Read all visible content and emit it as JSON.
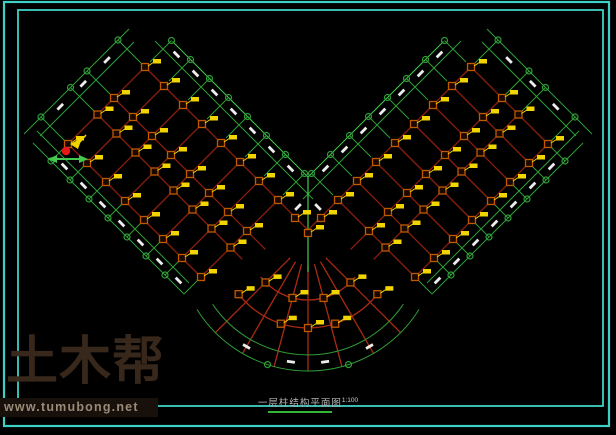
{
  "title_block": {
    "text": "一层柱结构平面图",
    "scale": "1:100"
  },
  "watermark": {
    "brand": "土木帮",
    "url": "www.tumubong.net"
  },
  "colors": {
    "background": "#000000",
    "frame_cyan": "#3fd0c5",
    "axis_green": "#2f9e38",
    "bright_green": "#43c94d",
    "beam_red": "#8b1e0c",
    "fan_red": "#aa2a12",
    "marker_orange": "#c05a00",
    "marker_yellow": "#f2d400",
    "dash_white": "#ededed",
    "symbol_red": "#e81818",
    "title_underline": "#35b535"
  },
  "drawing": {
    "canvas": {
      "w": 616,
      "h": 435
    },
    "mirror_axis": 308,
    "frame": {
      "outer": [
        4,
        2,
        605,
        424
      ],
      "inner": [
        18,
        10,
        585,
        396
      ]
    },
    "wing": {
      "end_s": 158,
      "end_s2": 176,
      "long_axes_c": [
        76,
        17,
        -16,
        -78
      ],
      "short_axes_s": [
        212,
        250,
        288,
        326,
        364,
        402,
        440,
        478
      ],
      "outer_lines_c": [
        94,
        110
      ],
      "inner_lines_c": [
        -114,
        -131
      ],
      "red_end_base": 478,
      "red_end_slope": 0.4,
      "green_long_until_s": 216,
      "outer_green_until_c": 52,
      "inner_green_from_c": -88,
      "dash_end_s": 167,
      "dash_outer_c": 102,
      "dash_inner_c": -122
    },
    "fan": {
      "cx": 308,
      "cy": 240,
      "radial_angles": [
        -45,
        -30,
        -15,
        0,
        15,
        30,
        45
      ],
      "radial_r": [
        25,
        131
      ],
      "red_arc_r": [
        60,
        88
      ],
      "red_arc_span": 52,
      "green_arc_r": [
        115,
        131
      ],
      "green_arc_span": [
        56,
        58
      ],
      "circle_angles": [
        -18,
        18
      ],
      "dash_angles": [
        -30,
        -8,
        8,
        30
      ],
      "dash_r": 123,
      "markers": [
        {
          "r": 60,
          "angles": [
            -45,
            -15,
            15,
            45
          ]
        },
        {
          "r": 88,
          "angles": [
            -52,
            -18,
            0,
            18,
            52
          ]
        }
      ]
    },
    "vertex": {
      "apex": [
        308,
        177
      ],
      "vline_y2": 272,
      "extra_markers": [
        [
          295,
          218
        ],
        [
          321,
          218
        ],
        [
          308,
          233
        ]
      ],
      "extra_dashes": [
        [
          298,
          207,
          -45
        ],
        [
          318,
          207,
          45
        ]
      ]
    },
    "benchmark": {
      "x": 66,
      "y": 151
    }
  }
}
